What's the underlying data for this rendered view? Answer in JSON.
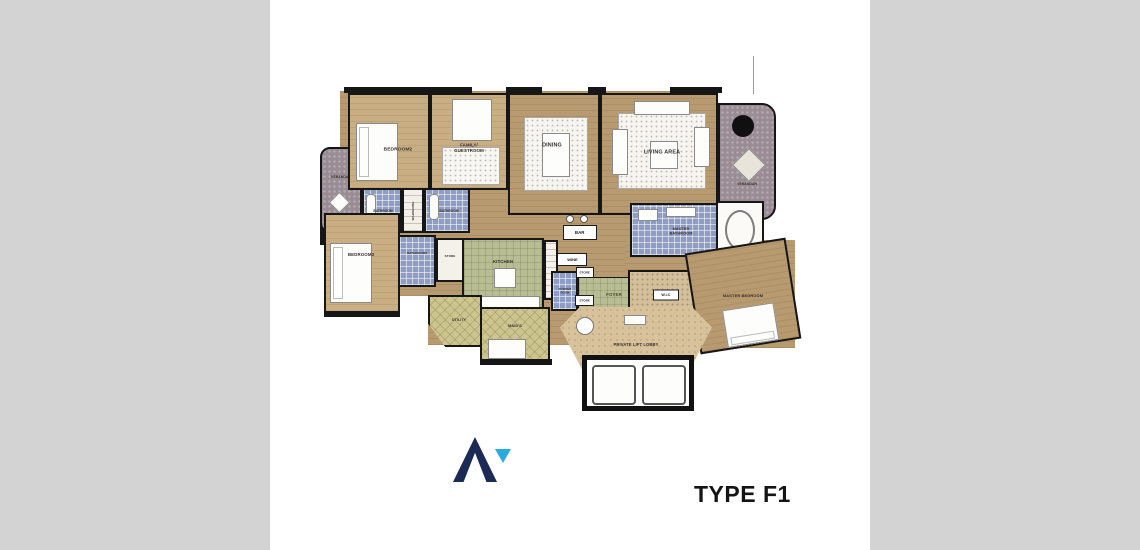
{
  "title": {
    "text": "TYPE F1"
  },
  "rooms": {
    "verandah_left": {
      "label": "VERANDAH"
    },
    "bedroom2": {
      "label": "BEDROOM2"
    },
    "bathroom_bedroom2": {
      "label": "BATHROOM"
    },
    "wardrobe": {
      "label": "WARDROBE"
    },
    "bathroom_guestroom": {
      "label": "BATHROOM"
    },
    "family_guestroom": {
      "label": "FAMILY/\nGUESTROOM"
    },
    "dining": {
      "label": "DINING"
    },
    "living_area": {
      "label": "LIVING AREA"
    },
    "verandah_right": {
      "label": "VERANDAH"
    },
    "bedroom3": {
      "label": "BEDROOM3"
    },
    "bathroom3": {
      "label": "BATHROOM3"
    },
    "store_main": {
      "label": "STORE"
    },
    "kitchen": {
      "label": "KITCHEN"
    },
    "utility": {
      "label": "UTILITY"
    },
    "maids": {
      "label": "MAID'S"
    },
    "bar": {
      "label": "BAR"
    },
    "wine": {
      "label": "WINE"
    },
    "store_upper": {
      "label": "STORE"
    },
    "powder_room": {
      "label": "POWDER\nROOM"
    },
    "store_lower": {
      "label": "STORE"
    },
    "foyer": {
      "label": "FOYER"
    },
    "master_bathroom": {
      "label": "MASTER\nBATHROOM"
    },
    "wic": {
      "label": "W.I.C"
    },
    "master_bedroom": {
      "label": "MASTER BEDROOM"
    },
    "private_lift_lobby": {
      "label": "PRIVATE LIFT LOBBY"
    }
  },
  "colors": {
    "side_panel": "#d3d3d3",
    "wood_floor": "#b79a6f",
    "wood_light": "#c8ae82",
    "tile_blue": "#8f9dc5",
    "kitchen_green": "#b9bd94",
    "khaki": "#cdc58f",
    "verandah_mauve": "#9a8c94",
    "lobby_tan": "#d8c29c",
    "wall_black": "#161616",
    "logo_navy": "#1b2b55",
    "logo_blue": "#29abe2"
  }
}
